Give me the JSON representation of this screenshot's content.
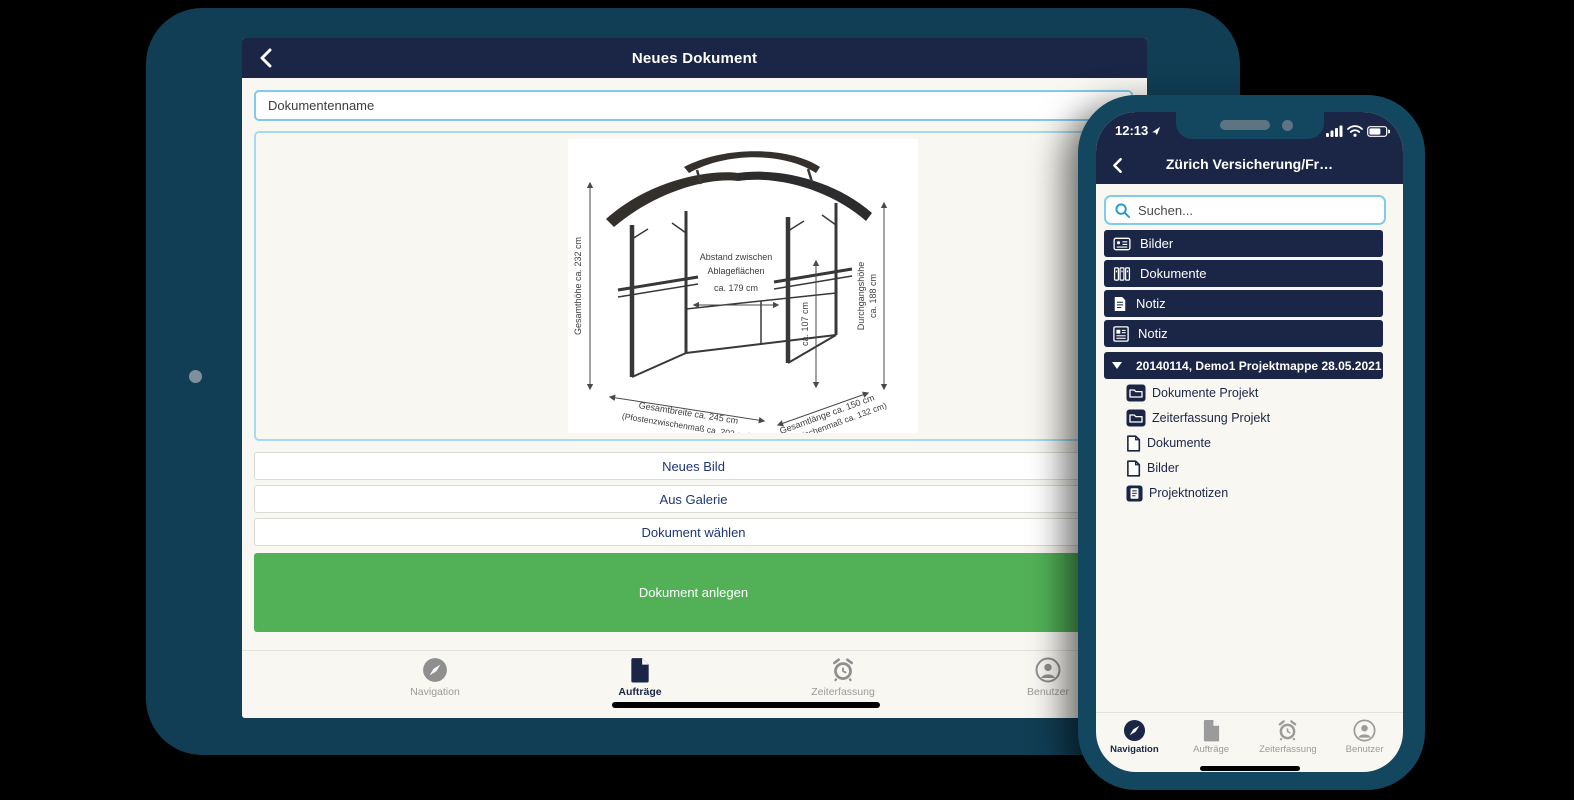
{
  "colors": {
    "device_frame": "#13475f",
    "navy": "#1b2647",
    "green": "#52b157",
    "light_blue_border": "#7fcbe9",
    "action_text_blue": "#1e3676",
    "search_icon_blue": "#1e9ad2",
    "inactive_gray": "#9b9b9b",
    "screen_bg": "#f8f7f2"
  },
  "tablet": {
    "header": {
      "title": "Neues Dokument"
    },
    "form": {
      "name_placeholder": "Dokumentenname"
    },
    "drawing": {
      "total_height": "Gesamthöhe ca. 232 cm",
      "shelf_gap_1": "Abstand zwischen",
      "shelf_gap_2": "Ablageflächen",
      "shelf_gap_3": "ca. 179 cm",
      "inner_height": "ca. 107 cm",
      "passage_height_1": "Durchgangshöhe",
      "passage_height_2": "ca. 188 cm",
      "width_1": "Gesamtbreite ca. 245 cm",
      "width_2": "(Pfostenzwischenmaß ca. 203 cm)",
      "length_1": "Gesamtlänge ca. 150 cm",
      "length_2": "(Pfostenzwischenmaß ca. 132 cm)"
    },
    "action_buttons": [
      {
        "label": "Neues Bild"
      },
      {
        "label": "Aus Galerie"
      },
      {
        "label": "Dokument wählen"
      }
    ],
    "primary_button": {
      "label": "Dokument anlegen"
    },
    "tabbar": [
      {
        "label": "Navigation",
        "icon": "compass-icon",
        "active": false
      },
      {
        "label": "Aufträge",
        "icon": "document-icon",
        "active": true
      },
      {
        "label": "Zeiterfassung",
        "icon": "alarm-icon",
        "active": false
      },
      {
        "label": "Benutzer",
        "icon": "user-icon",
        "active": false
      }
    ]
  },
  "phone": {
    "status": {
      "time": "12:13"
    },
    "header": {
      "title": "Zürich Versicherung/Fr…"
    },
    "search": {
      "placeholder": "Suchen..."
    },
    "folder_buttons": [
      {
        "label": "Bilder",
        "icon": "photo-card-icon"
      },
      {
        "label": "Dokumente",
        "icon": "binders-icon"
      },
      {
        "label": "Notiz",
        "icon": "note-page-icon"
      },
      {
        "label": "Notiz",
        "icon": "notepad-icon"
      }
    ],
    "project_row": {
      "label": "20140114, Demo1 Projektmappe 28.05.2021",
      "icon": "folder-outline-icon"
    },
    "tree_items": [
      {
        "label": "Dokumente Projekt",
        "icon": "folder-dark-icon"
      },
      {
        "label": "Zeiterfassung Projekt",
        "icon": "folder-dark-icon"
      },
      {
        "label": "Dokumente",
        "icon": "file-light-icon"
      },
      {
        "label": "Bilder",
        "icon": "file-light-icon"
      },
      {
        "label": "Projektnotizen",
        "icon": "note-dark-icon"
      }
    ],
    "tabbar": [
      {
        "label": "Navigation",
        "icon": "compass-icon",
        "active": true
      },
      {
        "label": "Aufträge",
        "icon": "document-icon",
        "active": false
      },
      {
        "label": "Zeiterfassung",
        "icon": "alarm-icon",
        "active": false
      },
      {
        "label": "Benutzer",
        "icon": "user-icon",
        "active": false
      }
    ]
  }
}
